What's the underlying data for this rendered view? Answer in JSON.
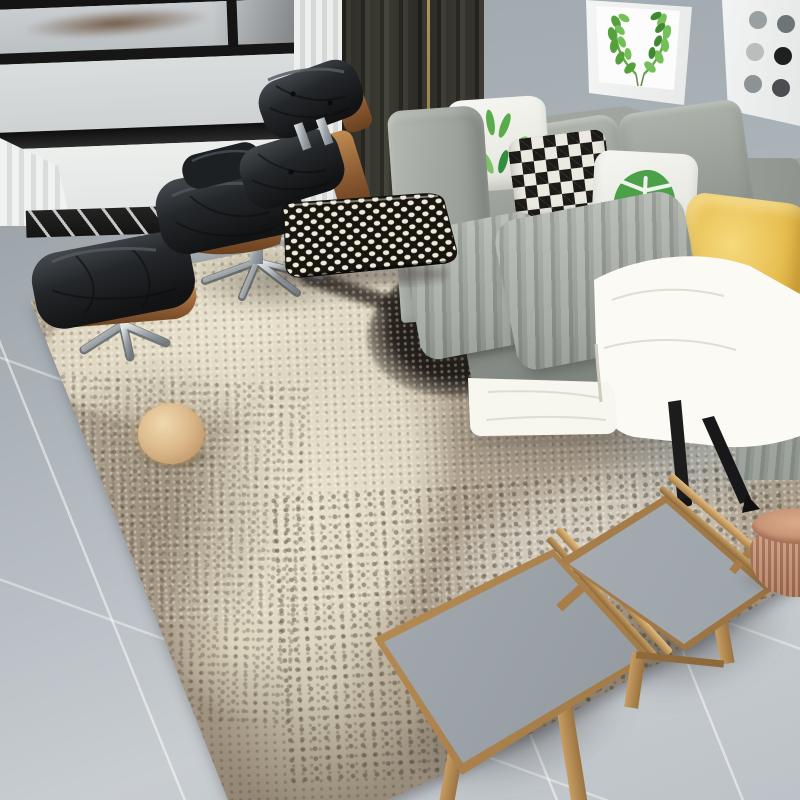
{
  "image": {
    "domain": "natural-image",
    "subject": "Modern living room lifestyle photo featuring an abstract distressed area rug",
    "style": "furniture product photograph, no visible text"
  },
  "palette": {
    "wall": "#a9b2b7",
    "floor_tile": "#bcc2c7",
    "window_frame_black": "#161616",
    "window_frame_white": "#eff1f0",
    "dark_curtain": "#35342e",
    "sheer_curtain": "#eceeed",
    "sofa_gray": "#9fa59e",
    "sofa_leg_black": "#1b1b1c",
    "rug_taupe": "#ab9d8b",
    "rug_cream": "#e6dfca",
    "rug_black": "#1d1a16",
    "rug_silver": "#d6cfc2",
    "leather_black": "#232629",
    "wood_walnut": "#8a5a32",
    "chrome": "#c9ced2",
    "stool_oak": "#c49a62",
    "stool_top_concrete": "#a3a9ae",
    "pouf_terracotta": "#c28f74",
    "blanket_white": "#fbfaf5",
    "pillow_yellow": "#e5bc52",
    "pillow_white": "#f4f4f0",
    "pillow_leaf_green": "#58ad4a",
    "pillow_diamond_black": "#1d1b17"
  },
  "objects": {
    "scene": {
      "label": "living room with gray sofa, black lounge chair and abstract area rug"
    },
    "wall": {
      "label": "plain gray wall"
    },
    "window": {
      "label": "black framed window with frosted panes and white sill"
    },
    "baseboard": {
      "label": "dark slatted vent strip below window"
    },
    "sheer_curtain": {
      "label": "white sheer curtain"
    },
    "dark_curtain": {
      "label": "dark charcoal drape with brass glint"
    },
    "wall_art_wreath": {
      "label": "framed watercolor green leaf wreath print"
    },
    "wall_art_circles": {
      "label": "framed gray circle grid print"
    },
    "sofa": {
      "label": "gray fabric three-seat sofa with black metal legs"
    },
    "pillows": {
      "leaf": {
        "label": "white pillow with green banana leaf print"
      },
      "diamond": {
        "label": "black and white diamond harlequin pillow"
      },
      "monstera": {
        "label": "white pillow with green monstera leaf print"
      },
      "yellow_front": {
        "label": "golden yellow satin pillow"
      },
      "yellow_back": {
        "label": "mustard yellow pillow"
      }
    },
    "throw_blanket": {
      "label": "white throw blanket draped off the seat onto the rug"
    },
    "lounge_chair": {
      "label": "black tufted leather lounge chair with walnut shell and chrome star base"
    },
    "ottoman": {
      "label": "black tufted leather ottoman with walnut shell and chrome base"
    },
    "floor_pillow": {
      "label": "black lumbar pillow with white dot houndstooth pattern resting on the rug"
    },
    "rug": {
      "label": "abstract distressed area rug in taupe, cream, black and silver with halftone dots"
    },
    "fur_ball": {
      "label": "round tan faux-fur ball on the rug"
    },
    "stool_left": {
      "label": "oak tray stool with concrete gray top and side rail"
    },
    "stool_right": {
      "label": "oak tray stool with concrete gray top and side rail"
    },
    "pouf": {
      "label": "round woven terracotta pouf, cropped at right edge"
    },
    "floor": {
      "label": "large light gray floor tiles with white grout"
    }
  }
}
